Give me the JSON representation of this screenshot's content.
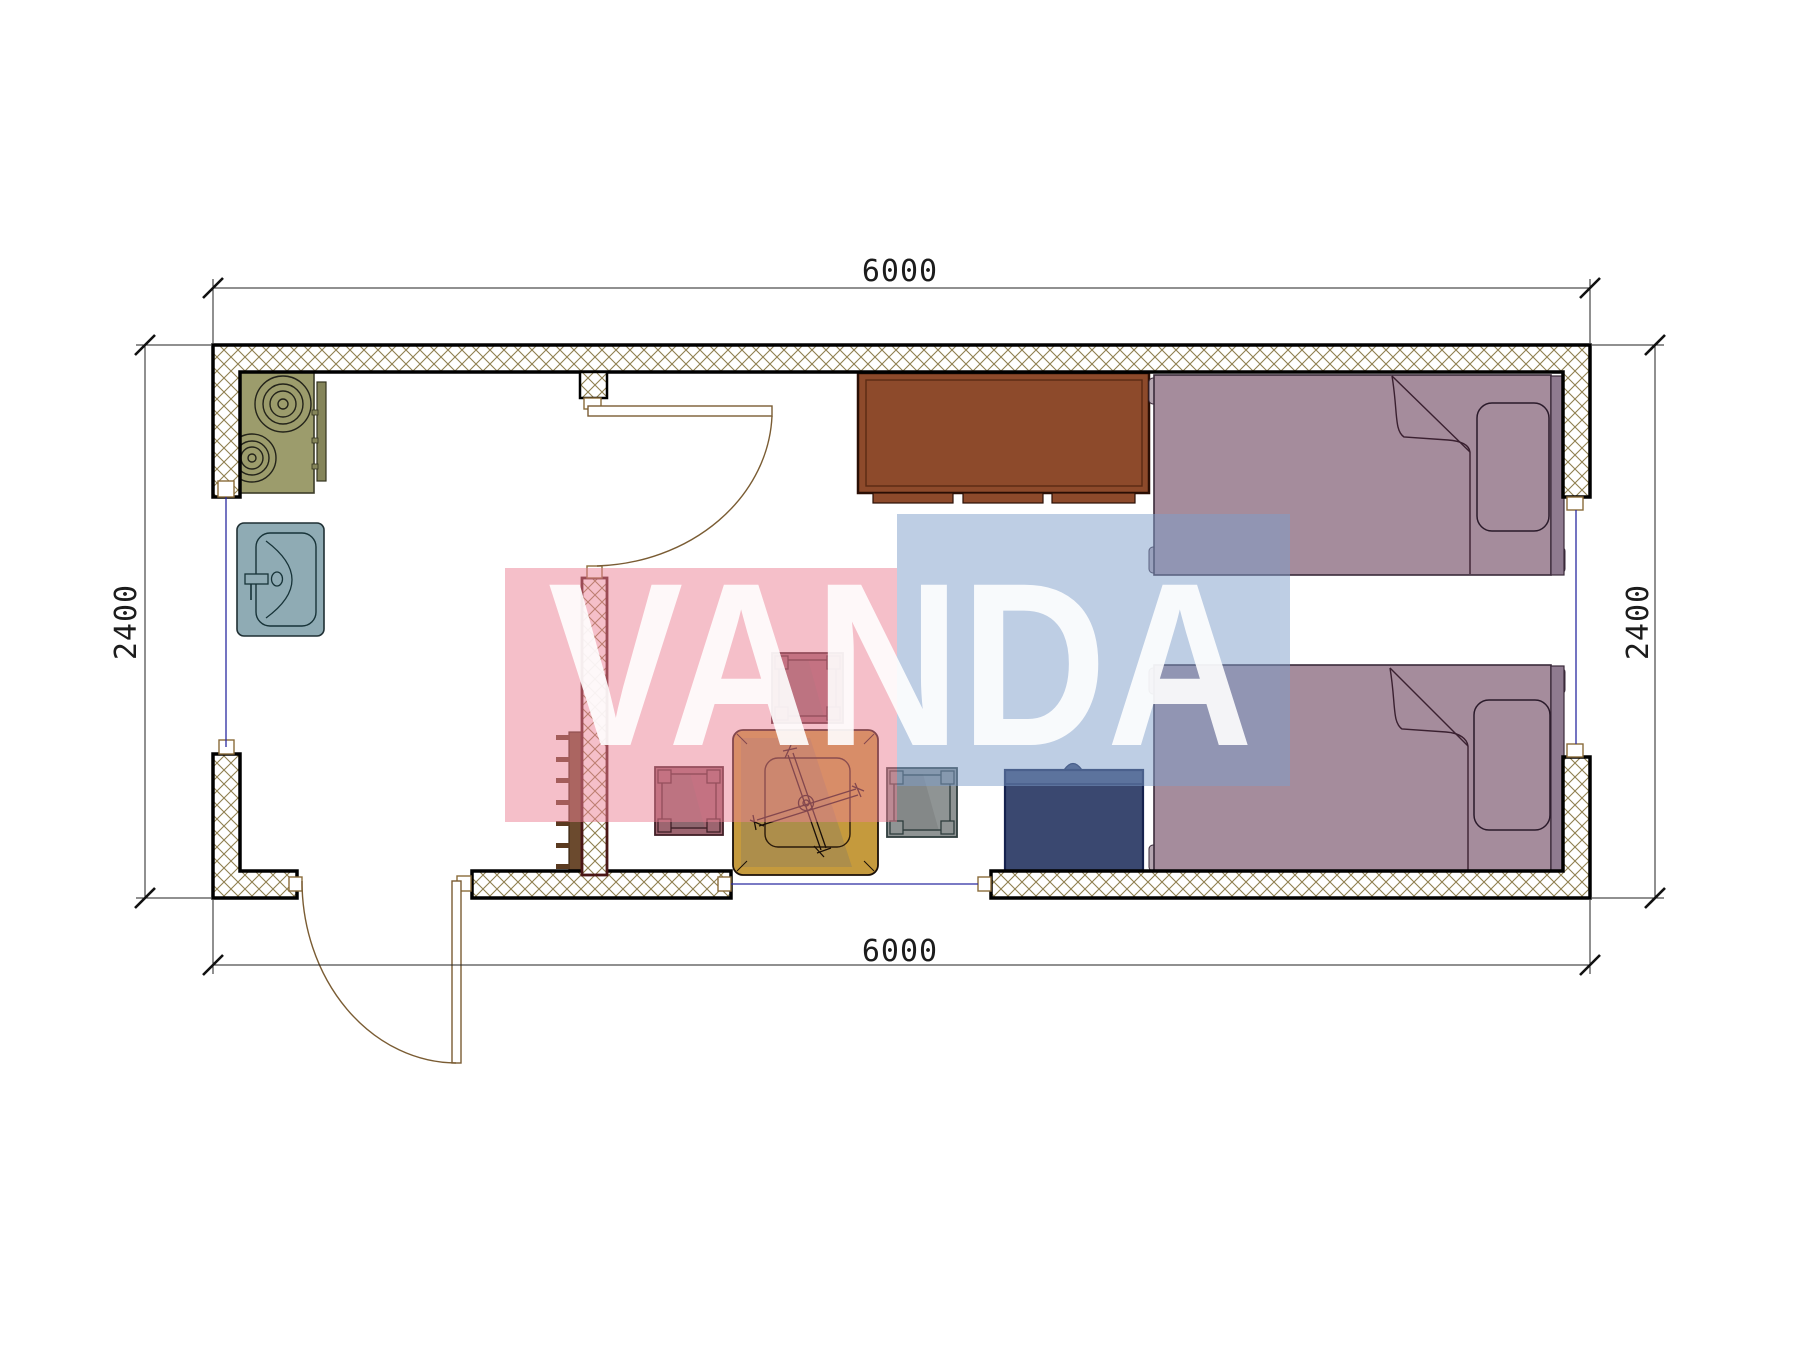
{
  "drawing": {
    "type": "architectural-floor-plan",
    "dimensions": {
      "top": "6000",
      "bottom": "6000",
      "left": "2400",
      "right": "2400"
    },
    "watermark": {
      "text": "VANDA",
      "pink": "#ec8094",
      "blue": "#7e9dca",
      "letters": "#ffffff"
    },
    "colors": {
      "wall_outline": "#000000",
      "partition_outline": "#4a1616",
      "hatch_line": "#8f7f4f",
      "door_line": "#7a5c33",
      "utility_line": "#2a2aa0",
      "dim_line": "#222222",
      "stove": "#9c9c6c",
      "stove_handle": "#85855a",
      "sink": "#8fabb4",
      "cabinet": "#8d4a2b",
      "bed": "#a58c9c",
      "headboard": "#8f7b90",
      "bedpost": "#b5a5b0",
      "navy_cabinet": "#3a4870",
      "table": "#c59a3d",
      "stool_mauve": "#9d6570",
      "stool_gray": "#8f9494",
      "shelf": "#6b4a2e"
    },
    "symbols": [
      "stove-icon",
      "sink-icon",
      "cabinet-icon",
      "bed-icon",
      "pillow-icon",
      "table-icon",
      "stool-icon",
      "door-swing-icon",
      "window-line-icon",
      "wall-hatch-icon",
      "dimension-tick-icon"
    ]
  }
}
